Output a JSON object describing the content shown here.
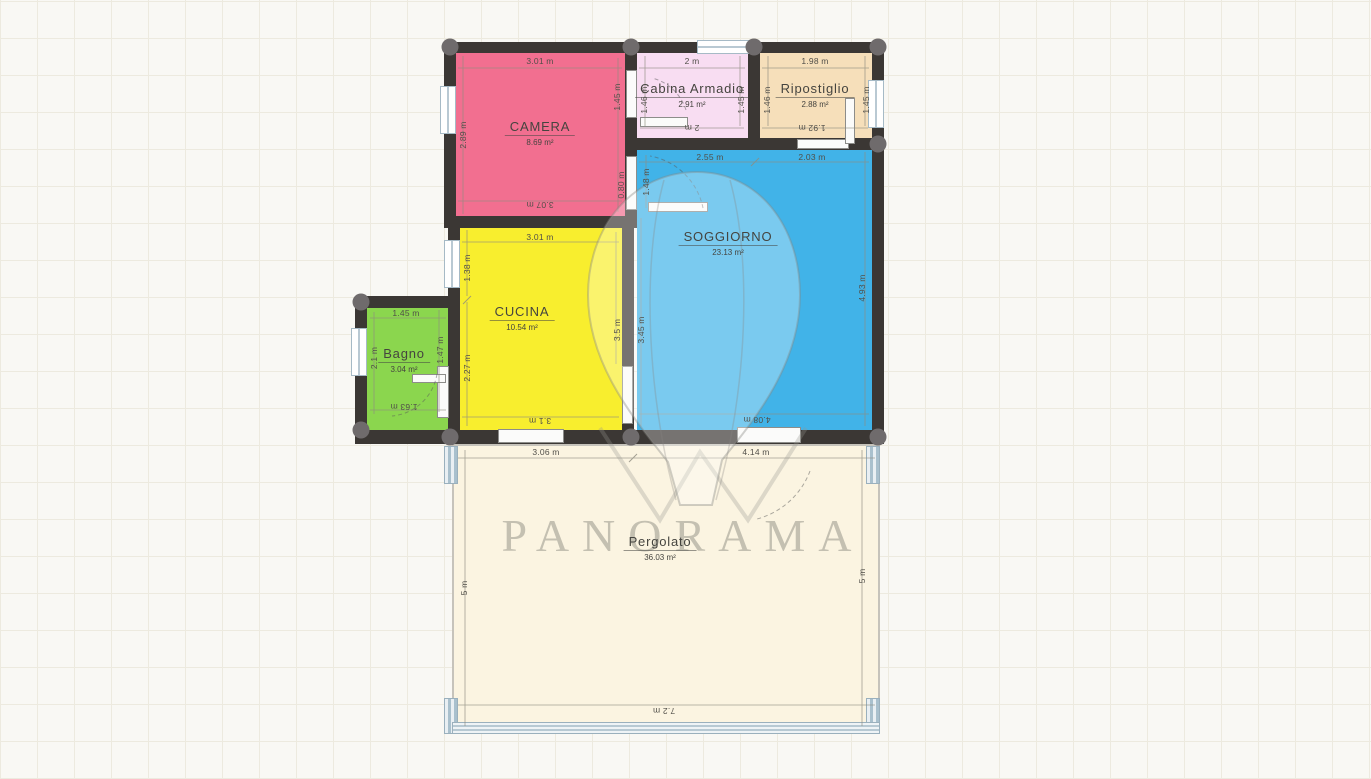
{
  "watermark": {
    "text": "PANORAMA"
  },
  "colors": {
    "wall": "#3b3734",
    "column": "#6f6b6c",
    "background": "#f9f8f4",
    "grid_line": "#edeadf",
    "window_frame": "#a6bac6",
    "camera": "#f26f90",
    "cabina": "#f8ddf2",
    "ripostiglio": "#f6dfba",
    "soggiorno": "#41b3e8",
    "cucina": "#f8ee2e",
    "bagno": "#8bd64e",
    "pergolato": "#fbf4e1"
  },
  "rooms": {
    "camera": {
      "name": "CAMERA",
      "area": "8.69 m²",
      "color": "#f26f90",
      "dim_top": "3.01 m",
      "dim_bottom": "3.07 m",
      "dim_left": "2.89 m",
      "dim_right": "1.45 m",
      "dim_right_lower": "0.80 m"
    },
    "cabina": {
      "name": "Cabina Armadio",
      "area": "2.91 m²",
      "color": "#f8ddf2",
      "dim_top": "2 m",
      "dim_bottom": "2 m",
      "dim_left": "1.46 m",
      "dim_right": "1.45 m"
    },
    "ripostiglio": {
      "name": "Ripostiglio",
      "area": "2.88 m²",
      "color": "#f6dfba",
      "dim_top": "1.98 m",
      "dim_bottom": "1.92 m",
      "dim_left": "1.46 m",
      "dim_right": "1.45 m"
    },
    "soggiorno": {
      "name": "SOGGIORNO",
      "area": "23.13 m²",
      "color": "#41b3e8",
      "dim_top_left": "2.55 m",
      "dim_top_right": "2.03 m",
      "dim_left_upper": "1.48 m",
      "dim_left_lower": "3.45 m",
      "dim_right": "4.93 m",
      "dim_bottom": "4.08 m"
    },
    "cucina": {
      "name": "CUCINA",
      "area": "10.54 m²",
      "color": "#f8ee2e",
      "dim_top": "3.01 m",
      "dim_bottom": "3.1 m",
      "dim_left_upper": "1.38 m",
      "dim_left_lower": "2.27 m",
      "dim_right": "3.5 m"
    },
    "bagno": {
      "name": "Bagno",
      "area": "3.04 m²",
      "color": "#8bd64e",
      "dim_top": "1.45 m",
      "dim_bottom": "1.63 m",
      "dim_left": "2.1 m",
      "dim_right": "1.47 m"
    },
    "pergolato": {
      "name": "Pergolato",
      "area": "36.03 m²",
      "color": "#fbf4e1",
      "dim_top_left": "3.06 m",
      "dim_top_right": "4.14 m",
      "dim_left": "5 m",
      "dim_right": "5 m",
      "dim_bottom": "7.2 m"
    }
  }
}
